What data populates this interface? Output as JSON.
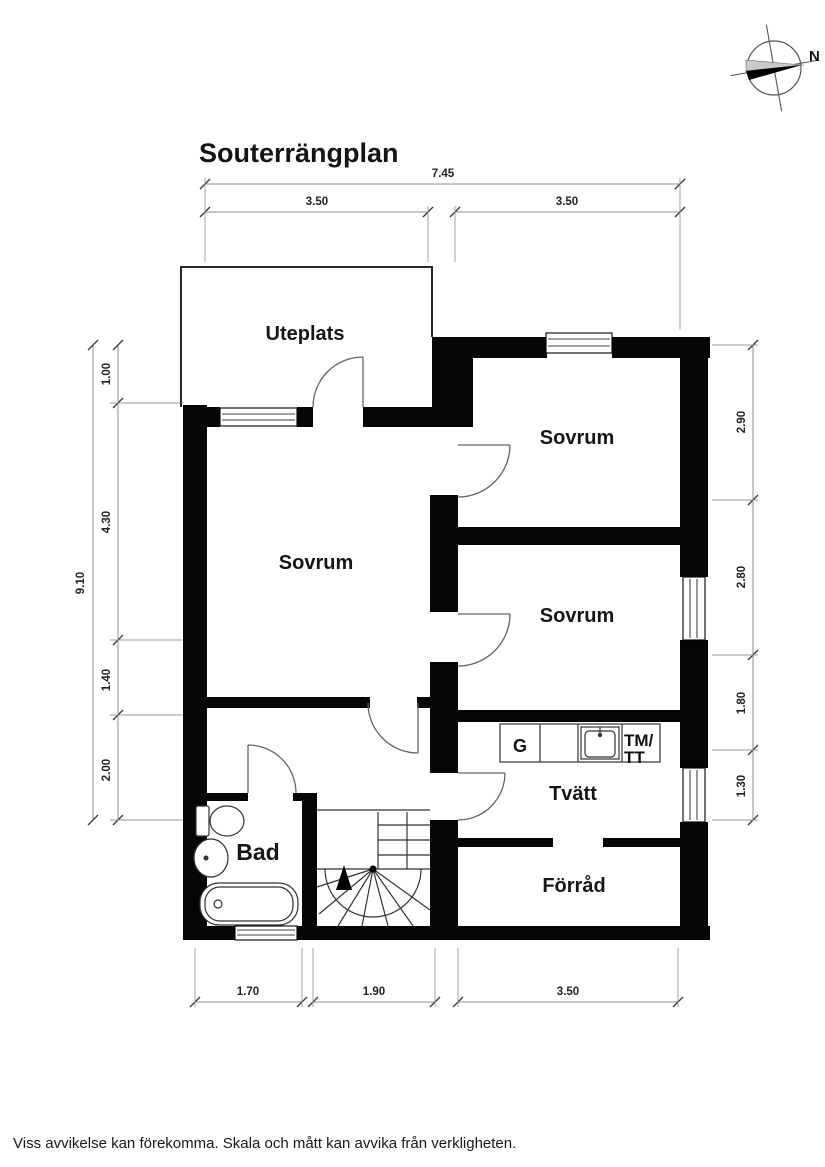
{
  "title": "Souterrängplan",
  "compass": {
    "north_label": "N"
  },
  "rooms": {
    "uteplats": "Uteplats",
    "sovrum_left": "Sovrum",
    "sovrum_top_right": "Sovrum",
    "sovrum_mid_right": "Sovrum",
    "bad": "Bad",
    "tvatt": "Tvätt",
    "forrad": "Förråd"
  },
  "appliances": {
    "cabinet": "G",
    "washer": "TM/",
    "dryer": "TT"
  },
  "dimensions": {
    "top_total": "7.45",
    "top_left": "3.50",
    "top_right": "3.50",
    "left_total": "9.10",
    "left_segments": [
      "1.00",
      "4.30",
      "1.40",
      "2.00"
    ],
    "right_segments": [
      "2.90",
      "2.80",
      "1.80",
      "1.30"
    ],
    "bottom_segments": [
      "1.70",
      "1.90",
      "3.50"
    ]
  },
  "footer": {
    "disclaimer": "Viss avvikelse kan förekomma. Skala och mått kan avvika från verkligheten."
  }
}
